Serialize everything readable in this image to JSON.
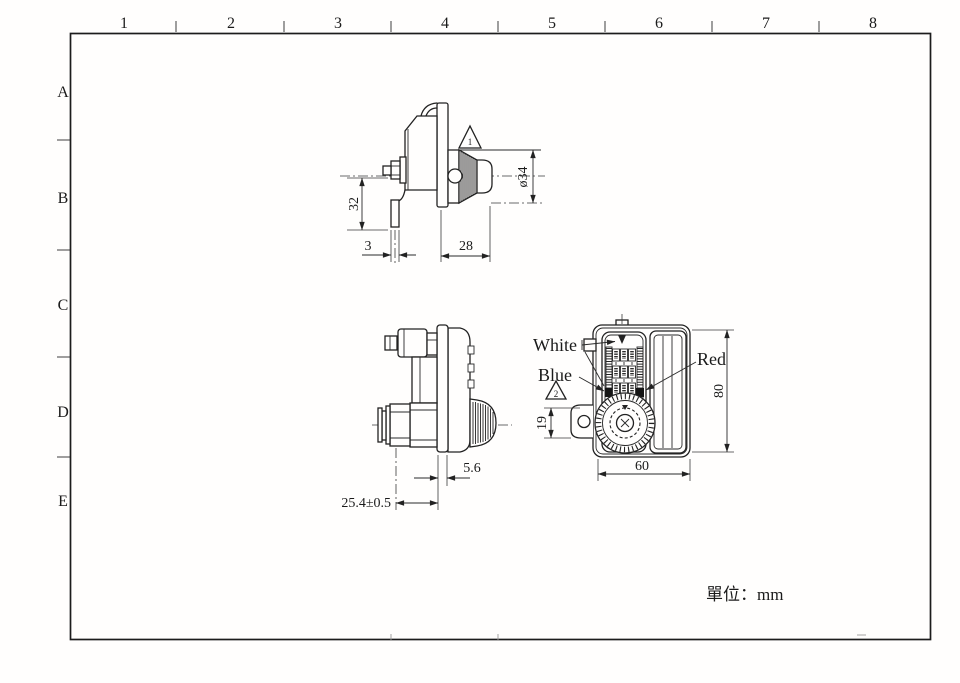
{
  "drawing": {
    "unit_note": "單位：mm",
    "border": {
      "columns": [
        "1",
        "2",
        "3",
        "4",
        "5",
        "6",
        "7",
        "8"
      ],
      "rows": [
        "A",
        "B",
        "C",
        "D",
        "E"
      ]
    },
    "views": {
      "side_upper": {
        "dim_height": "32",
        "dim_leg_width": "3",
        "dim_depth": "28",
        "dim_knob_diameter": "ø34",
        "revision_mark": "1"
      },
      "side_lower": {
        "dim_plate_offset": "5.6",
        "dim_grip_length": "25.4±0.5"
      },
      "front": {
        "label_white": "White",
        "label_blue": "Blue",
        "label_red": "Red",
        "dim_height": "80",
        "dim_width": "60",
        "dim_ear": "19",
        "revision_mark": "2"
      }
    }
  }
}
